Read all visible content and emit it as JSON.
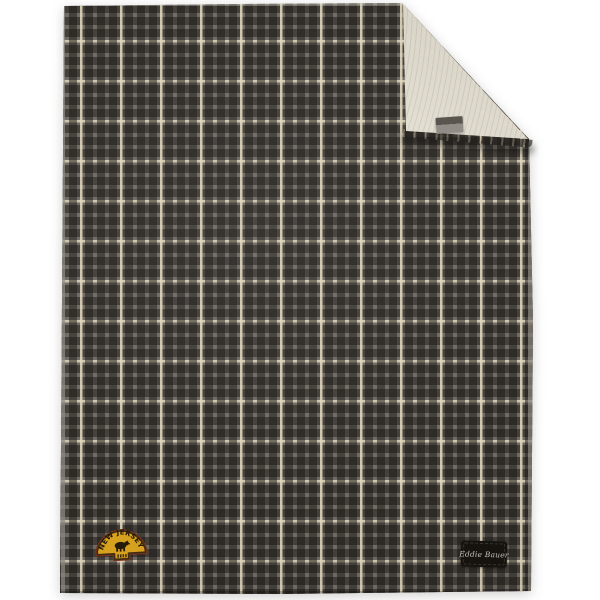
{
  "scene": {
    "background": "#ffffff",
    "subject": "Gray plaid fleece blanket lying flat, top-right corner folded over to reveal cream sherpa fleece lining",
    "view": "flat product photo"
  },
  "blanket": {
    "plaid_colors": {
      "base_gray": "#6f6a63",
      "dark_band": "#38342f",
      "cream_stripe": "#d8ceb3"
    },
    "plaid_repeat_px": 40,
    "sherpa_color": "#e2ddd0",
    "hem_color": "#b9b3a7"
  },
  "fold_tag": {
    "top_color": "#57524b",
    "bottom_color": "#908b84"
  },
  "patch": {
    "text": "NEW JERSEY",
    "emblem": "black bear silhouette",
    "colors": {
      "gold": "#d7a120",
      "border_inner": "#3f2c12",
      "border_outer": "#7c3420",
      "text": "#221808"
    }
  },
  "brand_label": {
    "text": "Eddie Bauer",
    "background": "#16130f",
    "text_color": "#c6c2b9"
  }
}
